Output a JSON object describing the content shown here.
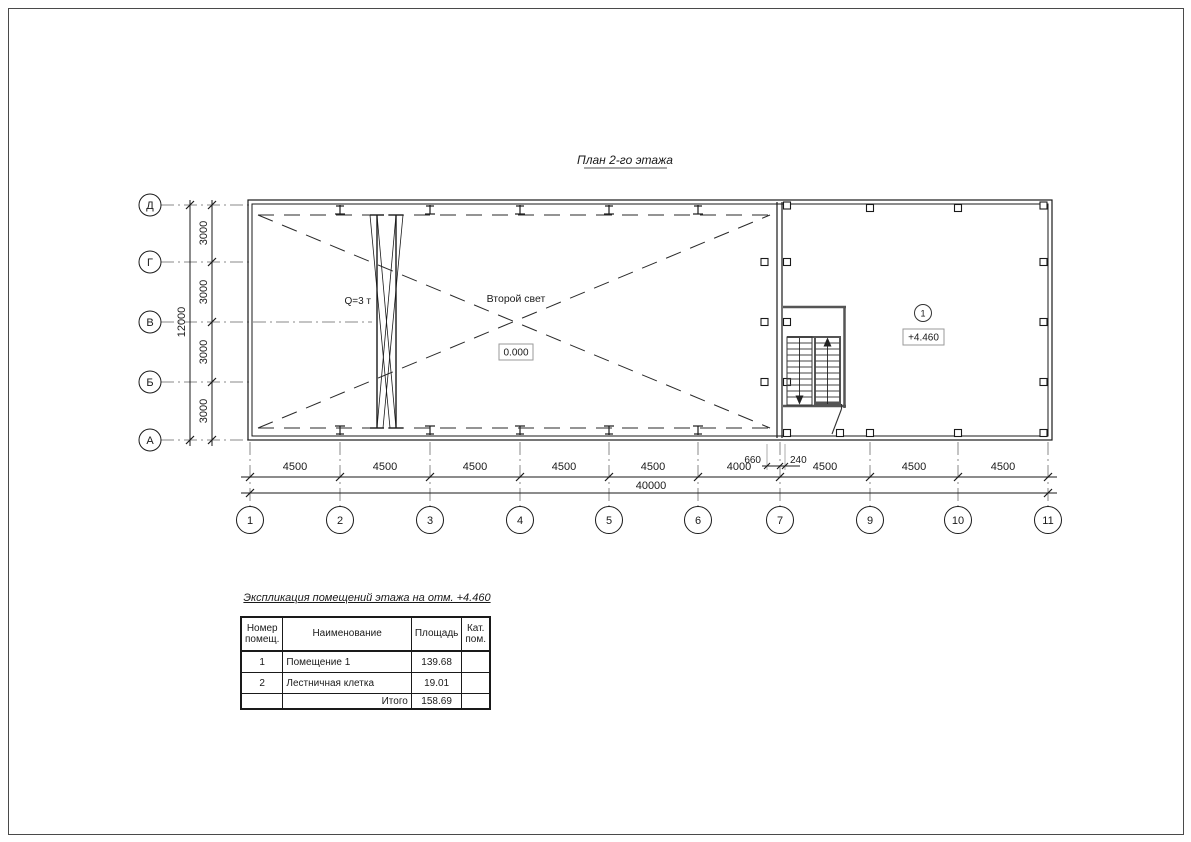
{
  "page": {
    "title": "План 2-го этажа"
  },
  "axes": {
    "rows": [
      "Д",
      "Г",
      "В",
      "Б",
      "А"
    ],
    "cols": [
      "1",
      "2",
      "3",
      "4",
      "5",
      "6",
      "7",
      "9",
      "10",
      "11"
    ],
    "row_segment_dims": [
      "3000",
      "3000",
      "3000",
      "3000"
    ],
    "row_total_dim": "12000",
    "col_segment_dims": [
      "4500",
      "4500",
      "4500",
      "4500",
      "4500",
      "4000",
      "4500",
      "4500",
      "4500"
    ],
    "col_total_dim": "40000",
    "offset_dims": [
      "660",
      "240"
    ]
  },
  "plan": {
    "crane_label": "Q=3 т",
    "void_label": "Второй свет",
    "level_mark_ground": "0.000",
    "room_number_tag": "1",
    "level_mark_floor": "+4.460"
  },
  "explication": {
    "title": "Экспликация помещений этажа на отм. +4.460",
    "headers": [
      "Номер\nпомещ.",
      "Наименование",
      "Площадь",
      "Кат.\nпом."
    ],
    "rows": [
      {
        "num": "1",
        "name": "Помещение 1",
        "area": "139.68",
        "cat": ""
      },
      {
        "num": "2",
        "name": "Лестничная клетка",
        "area": "19.01",
        "cat": ""
      }
    ],
    "total_label": "Итого",
    "total_value": "158.69"
  }
}
